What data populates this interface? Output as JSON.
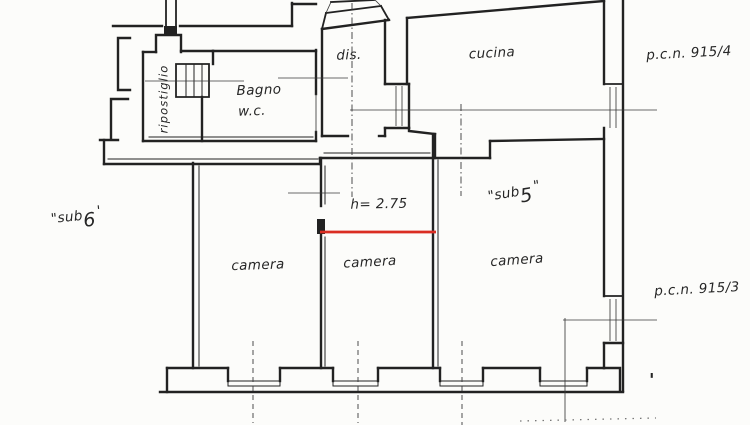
{
  "document": {
    "kind": "cadastral floor plan (hand-drawn scan)"
  },
  "palette": {
    "paper": "#fcfcfa",
    "ink": "#222222",
    "faint": "#777777",
    "red": "#da2d22"
  },
  "labels": {
    "ripostiglio": "ripostiglio",
    "bagno": "Bagno",
    "wc": "w.c.",
    "dis": "dis.",
    "cucina": "cucina",
    "pcn_915_4": "p.c.n. 915/4",
    "pcn_915_3": "p.c.n. 915/3",
    "sub5_word": "\"sub",
    "sub5_num": "5",
    "sub5_close": "\"",
    "sub6_word": "\"sub",
    "sub6_num": "6",
    "sub6_close": "'",
    "height_note": "h= 2.75",
    "camera_1": "camera",
    "camera_2": "camera",
    "camera_3": "camera",
    "stray_mark": "'"
  }
}
